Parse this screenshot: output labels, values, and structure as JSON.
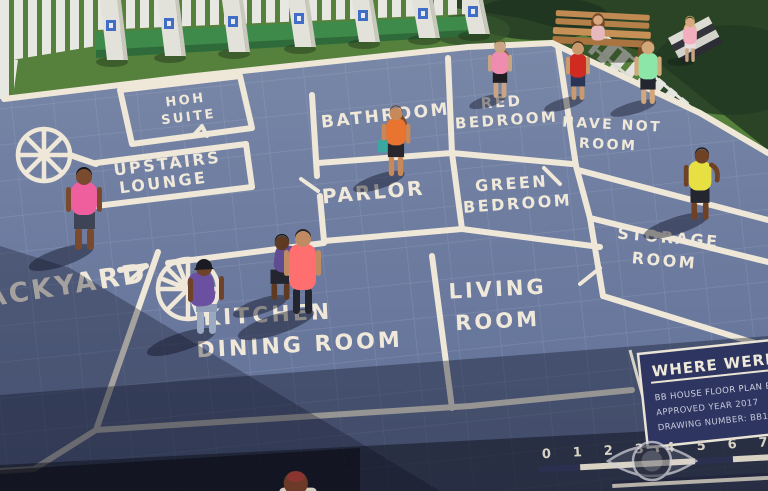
{
  "floor_plan": {
    "rooms": [
      {
        "id": "hoh-suite",
        "lines": [
          "HOH",
          "SUITE"
        ]
      },
      {
        "id": "upstairs-lounge",
        "lines": [
          "UPSTAIRS",
          "LOUNGE"
        ]
      },
      {
        "id": "bathroom",
        "lines": [
          "BATHROOM"
        ]
      },
      {
        "id": "parlor",
        "lines": [
          "PARLOR"
        ]
      },
      {
        "id": "red-bedroom",
        "lines": [
          "RED",
          "BEDROOM"
        ]
      },
      {
        "id": "green-bedroom",
        "lines": [
          "GREEN",
          "BEDROOM"
        ]
      },
      {
        "id": "have-not-room",
        "lines": [
          "HAVE NOT",
          "ROOM"
        ]
      },
      {
        "id": "storage-room",
        "lines": [
          "STORAGE",
          "ROOM"
        ]
      },
      {
        "id": "living-room",
        "lines": [
          "LIVING",
          "ROOM"
        ]
      },
      {
        "id": "kitchen-dining",
        "lines": [
          "KITCHEN",
          "DINING ROOM"
        ]
      },
      {
        "id": "backyard",
        "lines": [
          "BACKYARD"
        ]
      }
    ]
  },
  "title_block": {
    "title": "WHERE WERE Y",
    "rows": [
      "BB HOUSE FLOOR PLAN BLUE",
      "APPROVED YEAR 2017",
      "DRAWING NUMBER: BB19"
    ]
  },
  "ruler": {
    "numbers": [
      "0",
      "1",
      "2",
      "3",
      "4",
      "5",
      "6",
      "7"
    ]
  },
  "watermark": {
    "icon": "cbs-eye-logo"
  },
  "palette": {
    "mat": "#6e7da0",
    "wall_line": "#efe8d9",
    "label_text": "#f0e9da",
    "grass": "#55813c",
    "hedge": "#2b4426",
    "fence_white": "#e8e8e2",
    "bench_wood": "#b5804a",
    "title_block_bg": "#2e3560",
    "ruler_light": "#d9d3c5",
    "ruler_dark": "#2c3050",
    "plaque_blue": "#3f6dc8"
  },
  "people": [
    {
      "id": "man-pink-polo",
      "shirt": "#ef5f9d"
    },
    {
      "id": "man-coral-shirt",
      "shirt": "#ff6f70"
    },
    {
      "id": "person-purple-cap",
      "shirt": "#6b4fa1"
    },
    {
      "id": "person-purple-crouching",
      "shirt": "#5f4c92"
    },
    {
      "id": "woman-orange-top",
      "shirt": "#e87430"
    },
    {
      "id": "woman-pink-top",
      "shirt": "#f08cb0"
    },
    {
      "id": "man-red-shirt",
      "shirt": "#cf2b20"
    },
    {
      "id": "man-mint-shirt",
      "shirt": "#8ce6a8"
    },
    {
      "id": "woman-on-bench",
      "shirt": "#e7b9bd"
    },
    {
      "id": "woman-blonde-right",
      "shirt": "#f2aebc"
    },
    {
      "id": "man-yellow-shirt",
      "shirt": "#e7e042"
    },
    {
      "id": "person-bottom-edge",
      "shirt": "#d6cdbf"
    }
  ]
}
